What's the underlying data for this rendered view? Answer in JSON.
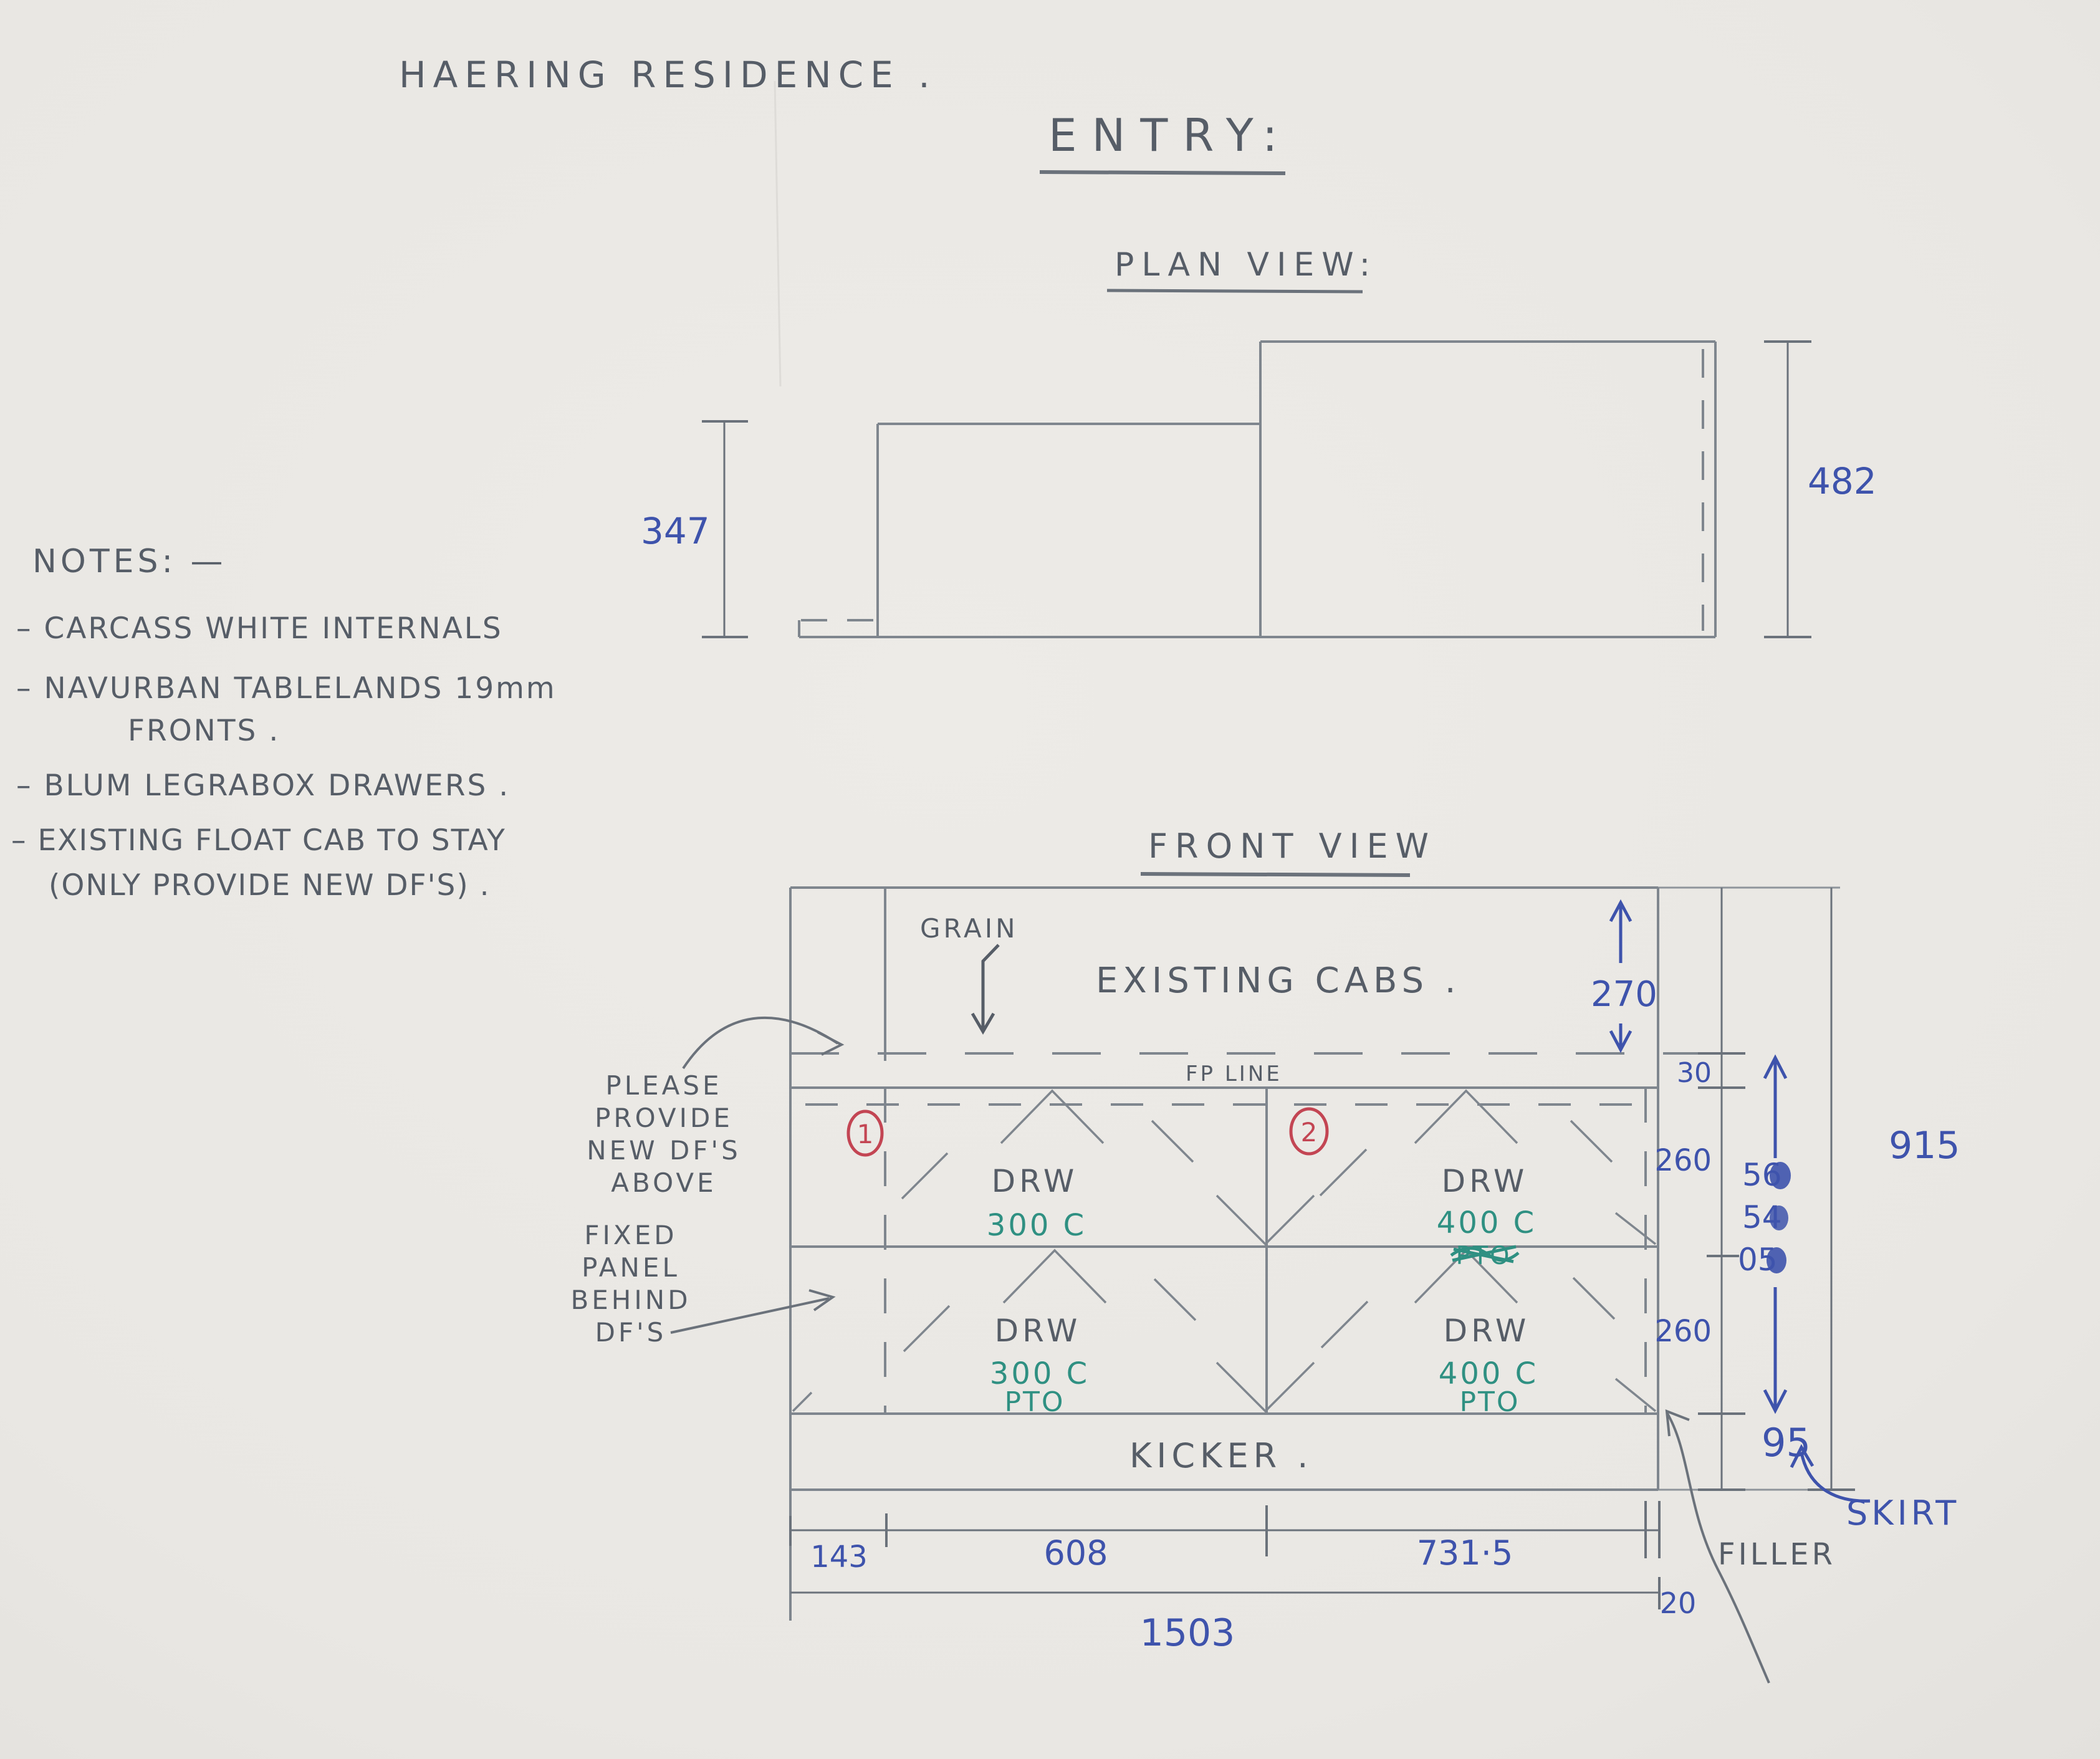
{
  "header": {
    "title": "HAERING RESIDENCE .",
    "section": "ENTRY:"
  },
  "notes": {
    "heading": "NOTES: —",
    "lines": [
      "– CARCASS WHITE INTERNALS",
      "– NAVURBAN TABLELANDS 19mm",
      "FRONTS .",
      "– BLUM LEGRABOX DRAWERS .",
      "– EXISTING FLOAT CAB TO STAY",
      "(ONLY PROVIDE NEW DF'S) ."
    ]
  },
  "plan_view": {
    "heading": "PLAN VIEW:",
    "dim_left": "347",
    "dim_right": "482"
  },
  "front_view": {
    "heading": "FRONT VIEW",
    "grain_label": "GRAIN",
    "existing_cabs_label": "EXISTING CABS .",
    "fp_line_label": "FP LINE",
    "kicker_label": "KICKER .",
    "skirt_label": "SKIRT",
    "filler_label": "FILLER",
    "annotation_provide": [
      "PLEASE",
      "PROVIDE",
      "NEW DF'S",
      "ABOVE"
    ],
    "annotation_fixed": [
      "FIXED",
      "PANEL",
      "BEHIND",
      "DF'S"
    ],
    "cab1": {
      "number": "1",
      "top_label": "DRW",
      "top_size": "300 C",
      "bottom_label": "DRW",
      "bottom_size": "300 C",
      "bottom_note": "PTO"
    },
    "cab2": {
      "number": "2",
      "top_label": "DRW",
      "top_size": "400 C",
      "top_note_struck": "PTO",
      "bottom_label": "DRW",
      "bottom_size": "400 C",
      "bottom_note": "PTO"
    },
    "dims": {
      "existing_height": "270",
      "fp_gap": "30",
      "drawer_top": "260",
      "drawer_bottom": "260",
      "kicker_height": "95",
      "overall_height": "915",
      "overwritten": [
        "56",
        "54",
        "05"
      ],
      "w_filler_left": "143",
      "w_front1": "608",
      "w_front2": "731·5",
      "w_filler_right": "20",
      "overall_width": "1503"
    },
    "colors": {
      "pencil": "#565d67",
      "blue_pen": "#3e53ac",
      "teal_pen": "#2f9082",
      "red_pen": "#c34553",
      "paper": "#e9e7e3"
    }
  }
}
